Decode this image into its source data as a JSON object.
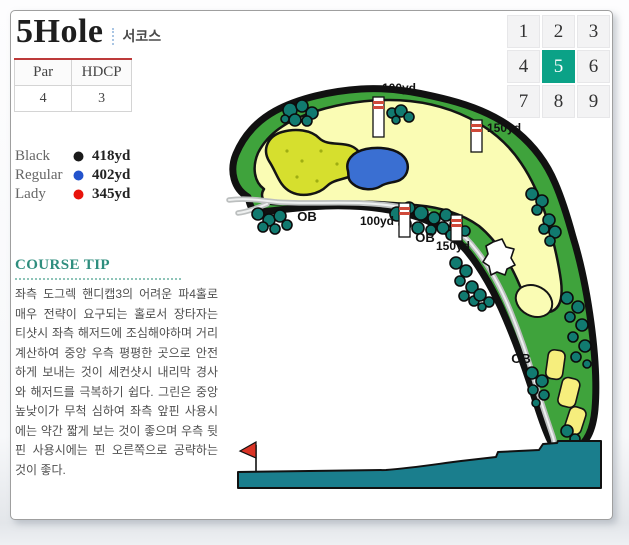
{
  "header": {
    "hole_title": "5Hole",
    "course_label": "서코스"
  },
  "info_table": {
    "headers": [
      "Par",
      "HDCP"
    ],
    "values": [
      "4",
      "3"
    ]
  },
  "tee_legend": [
    {
      "name": "Black",
      "color": "#1a1a1a",
      "distance": "418yd"
    },
    {
      "name": "Regular",
      "color": "#2353cc",
      "distance": "402yd"
    },
    {
      "name": "Lady",
      "color": "#e8130b",
      "distance": "345yd"
    }
  ],
  "course_tip": {
    "title": "COURSE TIP",
    "body": "좌측 도그렉 핸디캡3의 어려운 파4홀로 매우 전략이 요구되는 홀로서 장타자는 티샷시 좌측 해저드에 조심해야하며 거리계산하여 중앙 우측 평평한 곳으로 안전하게 보내는 것이 세컨샷시 내리막 경사와 해저드를 극복하기 쉽다. 그린은 중앙 높낮이가 무척 심하여 좌측 앞핀 사용시에는 약간 짧게 보는 것이 좋으며 우측 뒷핀 사용시에는 핀 오른쪽으로 공략하는 것이 좋다."
  },
  "hole_selector": {
    "numbers": [
      "1",
      "2",
      "3",
      "4",
      "5",
      "6",
      "7",
      "8",
      "9"
    ],
    "active": "5",
    "active_color": "#0ba287"
  },
  "map": {
    "distance_markers": [
      {
        "label": "100yd"
      },
      {
        "label": "150yd"
      },
      {
        "label": "100yd"
      },
      {
        "label": "150yd"
      }
    ],
    "ob_labels": [
      "OB",
      "OB",
      "OB"
    ],
    "colors": {
      "rough": "#3fa33c",
      "fairway": "#fafcb4",
      "putting_green": "#d6df2e",
      "water": "#3a6fd2",
      "bunker": "#ffffff",
      "trees": "#117a70",
      "cart_path": "#bcbfbf",
      "cart_path_center": "#eef0f0",
      "tee_boxes": "#f6ee7d",
      "marker_stripe": "#cf4a3a",
      "elevation_profile": "#1a7e8d",
      "flag": "#da3426",
      "outline": "#111111"
    }
  }
}
